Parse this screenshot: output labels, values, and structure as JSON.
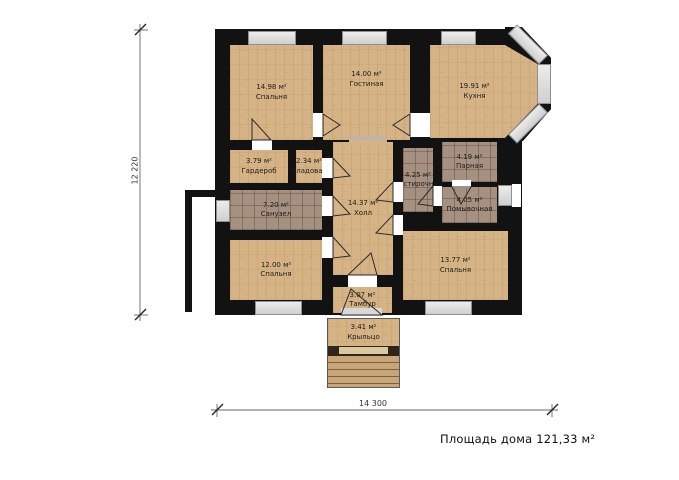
{
  "plan_title": "Площадь дома 121,33 м²",
  "dimensions": {
    "vertical": "12 220",
    "horizontal": "14 300"
  },
  "rooms": [
    {
      "id": "bedroom-top-left",
      "area": "14.98 м²",
      "name": "Спальня"
    },
    {
      "id": "living-room",
      "area": "14.00 м²",
      "name": "Гостиная"
    },
    {
      "id": "kitchen",
      "area": "19.91 м²",
      "name": "Кухня"
    },
    {
      "id": "wardrobe",
      "area": "3.79 м²",
      "name": "Гардероб"
    },
    {
      "id": "pantry",
      "area": "2.34 м²",
      "name": "Кладовая"
    },
    {
      "id": "hall",
      "area": "14.37 м²",
      "name": "Холл"
    },
    {
      "id": "bathroom",
      "area": "7.20 м²",
      "name": "Санузел"
    },
    {
      "id": "laundry",
      "area": "4.25 м²",
      "name": "Постирочная"
    },
    {
      "id": "steam-room",
      "area": "4.19 м²",
      "name": "Парная"
    },
    {
      "id": "washing-room",
      "area": "4.05 м²",
      "name": "Помывочная"
    },
    {
      "id": "bedroom-bottom-left",
      "area": "12.00 м²",
      "name": "Спальня"
    },
    {
      "id": "bedroom-bottom-right",
      "area": "13.77 м²",
      "name": "Спальня"
    },
    {
      "id": "tambour",
      "area": "3.07 м²",
      "name": "Тамбур"
    },
    {
      "id": "porch",
      "area": "3.41 м²",
      "name": "Крыльцо"
    }
  ],
  "colors": {
    "wood": "#d6b385",
    "tile": "#a69181",
    "wall": "#121212",
    "window": "#d6d6d6"
  }
}
